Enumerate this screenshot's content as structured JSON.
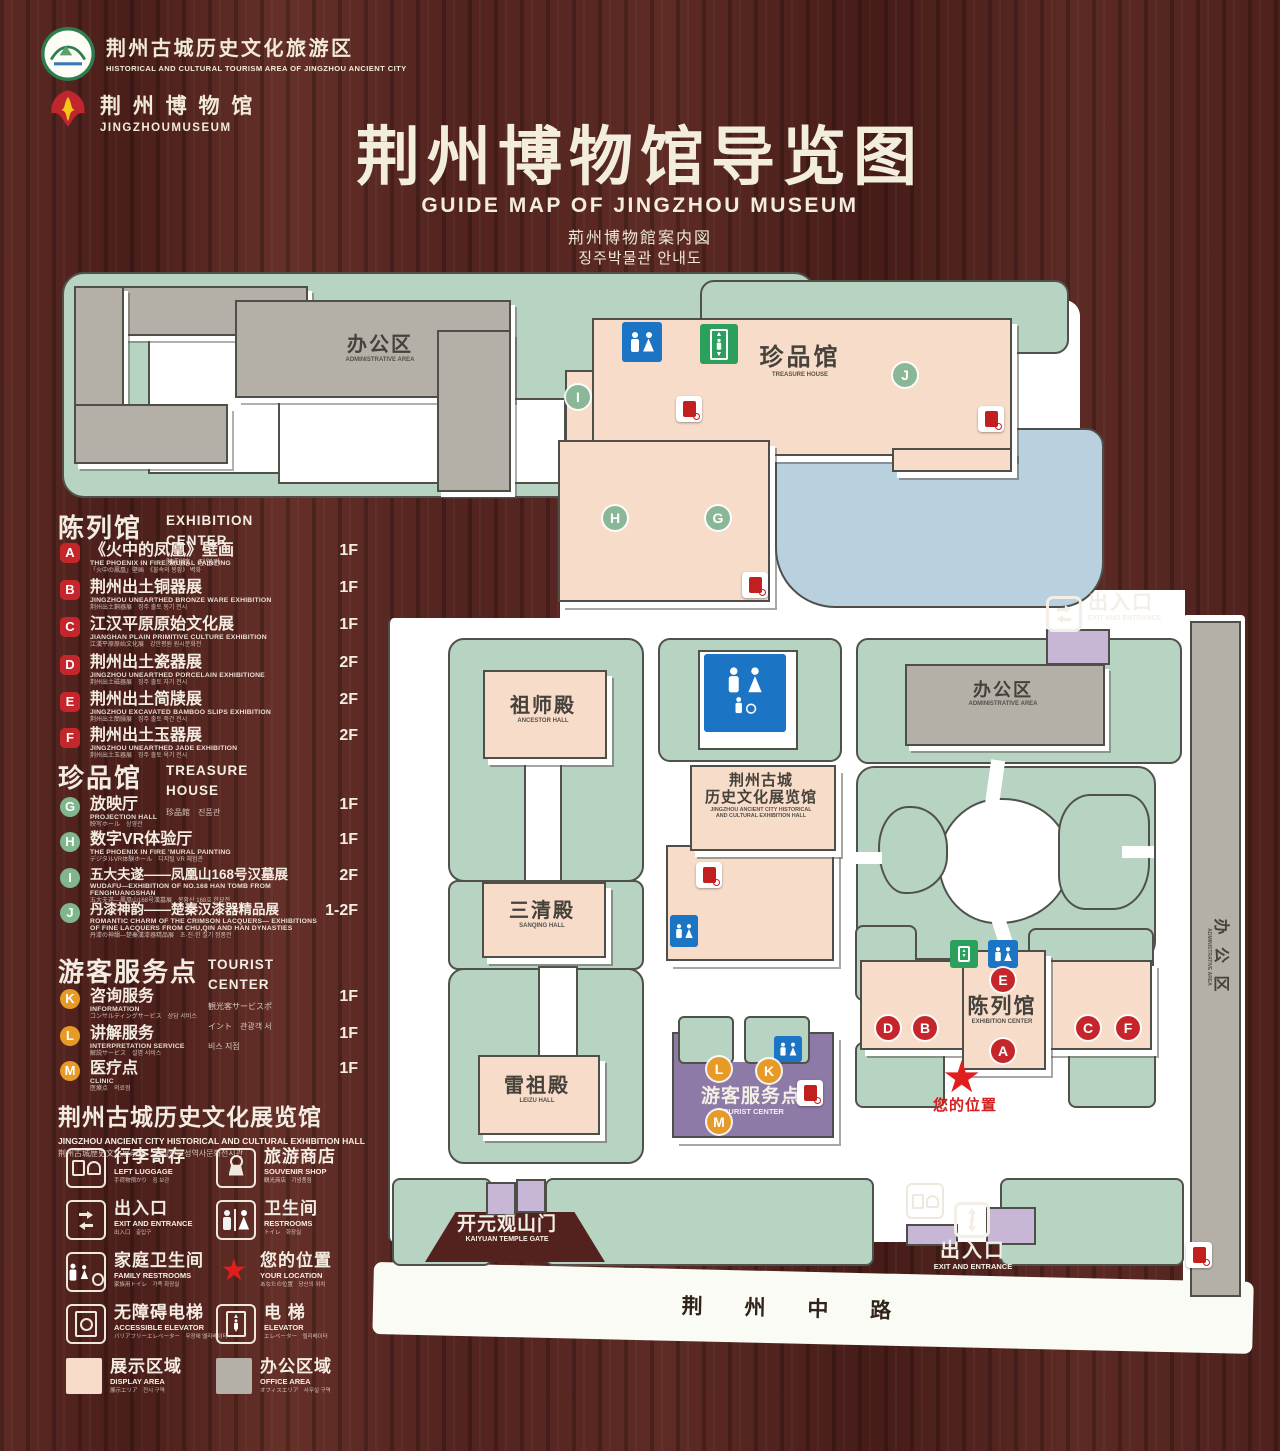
{
  "header": {
    "logo_tourism": {
      "cn": "荆州古城历史文化旅游区",
      "en": "HISTORICAL AND CULTURAL TOURISM AREA OF JINGZHOU ANCIENT CITY"
    },
    "logo_museum": {
      "cn": "荆 州 博 物 馆",
      "en": "JINGZHOUMUSEUM"
    },
    "title": "荆州博物馆导览图",
    "subtitle_en": "GUIDE MAP OF JINGZHOU MUSEUM",
    "subtitle_ja": "荊州博物館案内図",
    "subtitle_ko": "징주박물관 안내도"
  },
  "legend": {
    "sections": [
      {
        "title_cn": "陈列馆",
        "title_en": "EXHIBITION CENTER",
        "title_sub": "陳列館　진열관",
        "items": [
          {
            "letter": "A",
            "cn": "《火中的凤凰》壁画",
            "en": "THE PHOENIX IN FIRE 'MURAL PAINTING",
            "sub": "「火中の鳳凰」壁画　《불속의 봉황》 벽화",
            "floor": "1F"
          },
          {
            "letter": "B",
            "cn": "荆州出土铜器展",
            "en": "JINGZHOU UNEARTHED BRONZE WARE EXHIBITION",
            "sub": "荆州出土銅器展　징주 출토 동기 전시",
            "floor": "1F"
          },
          {
            "letter": "C",
            "cn": "江汉平原原始文化展",
            "en": "JIANGHAN PLAIN PRIMITIVE CULTURE EXHIBITION",
            "sub": "江漢平原原始文化展　강한평원 원시문화전",
            "floor": "1F"
          },
          {
            "letter": "D",
            "cn": "荆州出土瓷器展",
            "en": "JINGZHOU UNEARTHED PORCELAIN EXHIBITIONE",
            "sub": "荆州出土磁器展　징주 출토 자기 전시",
            "floor": "2F"
          },
          {
            "letter": "E",
            "cn": "荆州出土简牍展",
            "en": "JINGZHOU EXCAVATED BAMBOO SLIPS EXHIBITION",
            "sub": "荆州出土簡牘展　징주 출토 죽간 전시",
            "floor": "2F"
          },
          {
            "letter": "F",
            "cn": "荆州出土玉器展",
            "en": "JINGZHOU UNEARTHED JADE EXHIBITION",
            "sub": "荆州出土玉器展　징주 출토 옥기 전시",
            "floor": "2F"
          }
        ]
      },
      {
        "title_cn": "珍品馆",
        "title_en": "TREASURE HOUSE",
        "title_sub": "珍品館　진품관",
        "items": [
          {
            "letter": "G",
            "cn": "放映厅",
            "en": "PROJECTION HALL",
            "sub": "映写ホール　상영관",
            "floor": "1F"
          },
          {
            "letter": "H",
            "cn": "数字VR体验厅",
            "en": "THE PHOENIX IN FIRE 'MURAL PAINTING",
            "sub": "デジタルVR体験ホール　디지털 VR 체험관",
            "floor": "1F"
          },
          {
            "letter": "I",
            "cn": "五大夫遂——凤凰山168号汉墓展",
            "en": "WUDAFU—EXHIBITION OF NO.168 HAN TOMB FROM FENGHUANGSHAN",
            "sub": "五大夫遂—鳳凰山168号漢墓展　봉황산 168호 한묘전",
            "floor": "2F"
          },
          {
            "letter": "J",
            "cn": "丹漆神韵——楚秦汉漆器精品展",
            "en": "ROMANTIC CHARM OF THE CRIMSON LACQUERS— EXHIBITIONS OF FINE LACQUERS FROM CHU,QIN AND HAN DYNASTIES",
            "sub": "丹漆の神韻—楚秦漢漆器精品展　초·진·한 칠기 정품전",
            "floor": "1-2F"
          }
        ]
      },
      {
        "title_cn": "游客服务点",
        "title_en": "TOURIST CENTER",
        "title_sub": "観光客サービスポイント　관광객 서비스 지점",
        "items": [
          {
            "letter": "K",
            "cn": "咨询服务",
            "en": "INFORMATION",
            "sub": "コンサルティングサービス　상담 서비스",
            "floor": "1F"
          },
          {
            "letter": "L",
            "cn": "讲解服务",
            "en": "INTERPRETATION SERVICE",
            "sub": "解説サービス　설명 서비스",
            "floor": "1F"
          },
          {
            "letter": "M",
            "cn": "医疗点",
            "en": "CLINIC",
            "sub": "医療点　의료점",
            "floor": "1F"
          }
        ]
      }
    ],
    "hall_note": {
      "cn": "荆州古城历史文化展览馆",
      "en": "JINGZHOU ANCIENT CITY HISTORICAL AND CULTURAL EXHIBITION HALL",
      "sub": "荆州古城歴史文化展示館　　징주고성역사문화전시관"
    },
    "icons": [
      {
        "cn": "行李寄存",
        "en": "LEFT LUGGAGE",
        "sub": "手荷物預かり　짐 보관"
      },
      {
        "cn": "旅游商店",
        "en": "SOUVENIR SHOP",
        "sub": "観光商店　기념품점"
      },
      {
        "cn": "出入口",
        "en": "EXIT AND ENTRANCE",
        "sub": "出入口　출입구"
      },
      {
        "cn": "卫生间",
        "en": "RESTROOMS",
        "sub": "トイレ　화장실"
      },
      {
        "cn": "家庭卫生间",
        "en": "FAMILY RESTROOMS",
        "sub": "家族用トイレ　가족 화장실"
      },
      {
        "cn": "您的位置",
        "en": "YOUR LOCATION",
        "sub": "あなたの位置　당신의 위치"
      },
      {
        "cn": "无障碍电梯",
        "en": "ACCESSIBLE ELEVATOR",
        "sub": "バリアフリーエレベーター　무장애 엘리베이터"
      },
      {
        "cn": "电  梯",
        "en": "ELEVATOR",
        "sub": "エレベーター　엘리베이터"
      }
    ],
    "areas": [
      {
        "cn": "展示区域",
        "en": "DISPLAY AREA",
        "sub": "展示エリア　전시 구역",
        "color": "#f6dcc9"
      },
      {
        "cn": "办公区域",
        "en": "OFFICE AREA",
        "sub": "オフィスエリア　사무실 구역",
        "color": "#b4b0a7"
      }
    ]
  },
  "map": {
    "labels": {
      "admin_top": {
        "cn": "办公区",
        "en": "ADMINISTRATIVE AREA"
      },
      "treasure": {
        "cn": "珍品馆",
        "en": "TREASURE HOUSE"
      },
      "exit_top": {
        "cn": "出入口",
        "en": "EXIT AND ENTRANCE"
      },
      "admin_mid": {
        "cn": "办公区",
        "en": "ADMINISTRATIVE AREA"
      },
      "admin_side": {
        "cn": "办 公 区",
        "en": "ADMINISTRATIVE AREA"
      },
      "ancestor": {
        "cn": "祖师殿",
        "en": "ANCESTOR HALL"
      },
      "exhibition_hall": {
        "cn1": "荆州古城",
        "cn2": "历史文化展览馆",
        "en1": "JINGZHOU ANCIENT CITY HISTORICAL",
        "en2": "AND CULTURAL EXHIBITION HALL"
      },
      "sanqing": {
        "cn": "三清殿",
        "en": "SANQING HALL"
      },
      "leizu": {
        "cn": "雷祖殿",
        "en": "LEIZU HALL"
      },
      "exhibition_center": {
        "cn": "陈列馆",
        "en": "EXHIBITION CENTER"
      },
      "tourist": {
        "cn": "游客服务点",
        "en": "TOURIST CENTER"
      },
      "your_location": {
        "cn": "您的位置"
      },
      "gate": {
        "cn": "开元观山门",
        "en": "KAIYUAN TEMPLE GATE"
      },
      "exit_bottom": {
        "cn": "出入口",
        "en": "EXIT AND ENTRANCE"
      },
      "road": {
        "cn": "荆 州 中 路"
      }
    },
    "badges": [
      {
        "letter": "I",
        "color": "green"
      },
      {
        "letter": "J",
        "color": "green"
      },
      {
        "letter": "H",
        "color": "green"
      },
      {
        "letter": "G",
        "color": "green"
      },
      {
        "letter": "E",
        "color": "red"
      },
      {
        "letter": "D",
        "color": "red"
      },
      {
        "letter": "B",
        "color": "red"
      },
      {
        "letter": "A",
        "color": "red"
      },
      {
        "letter": "C",
        "color": "red"
      },
      {
        "letter": "F",
        "color": "red"
      },
      {
        "letter": "L",
        "color": "orange"
      },
      {
        "letter": "K",
        "color": "orange"
      },
      {
        "letter": "M",
        "color": "orange"
      }
    ],
    "colors": {
      "ground": "#b7d3c2",
      "display_area": "#f6dcc9",
      "office_area": "#b4b0a7",
      "lake": "#b9d1de",
      "tourist_center": "#8d7aa6",
      "entrance": "#c7b6d6",
      "badge_red": "#c5262b",
      "badge_green": "#8ab897",
      "badge_orange": "#e79b26",
      "wood": "#57231f",
      "star": "#e11d1d",
      "restroom_blue": "#1b74c4",
      "elevator_green": "#2aa05c"
    }
  }
}
